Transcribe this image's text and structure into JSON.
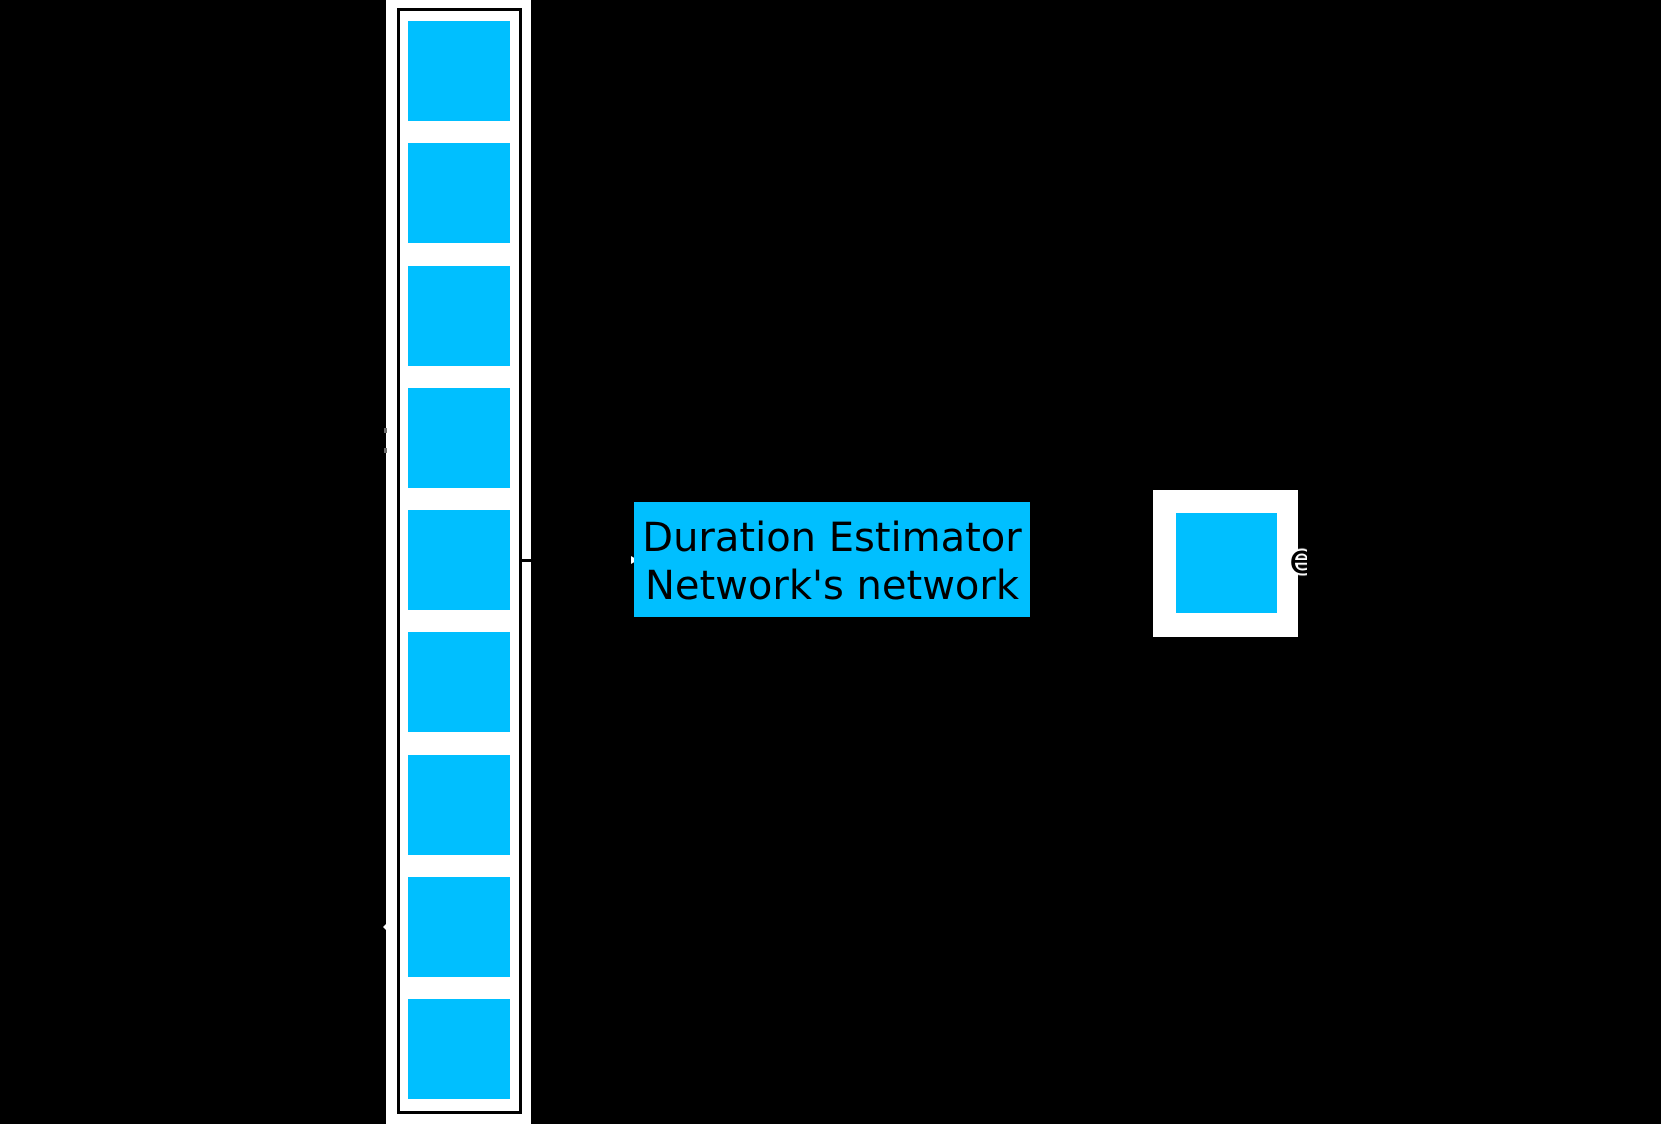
{
  "figure": {
    "background_color": "#000000",
    "block_color": "#00BFFF",
    "frame_color": "#FFFFFF",
    "text_color": "#000000",
    "phoneme_column": {
      "block_count": 9
    },
    "estimator_box": {
      "label_line1": "Duration Estimator",
      "label_line2": "Network's network",
      "fill_color": "#00BFFF"
    },
    "output_block": {
      "label": "e"
    }
  }
}
